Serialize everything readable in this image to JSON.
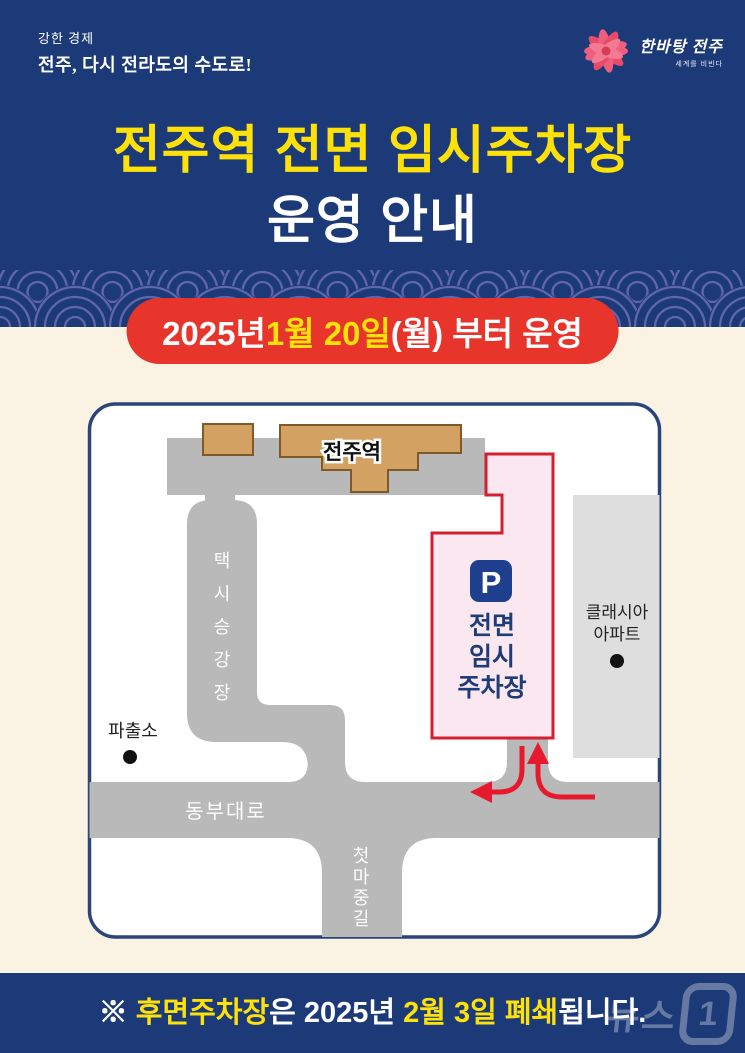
{
  "colors": {
    "header_blue": "#1d3a78",
    "wave_arc": "#6066aa",
    "cream": "#faf3e4",
    "banner_red": "#e8352c",
    "highlight_yellow": "#ffe10a",
    "road_gray": "#b9b9b9",
    "apartment_gray": "#dedede",
    "building_tan": "#d3a262",
    "building_border": "#7d5a28",
    "parking_pink": "#fbe7f0",
    "parking_border_red": "#d31f2f",
    "p_icon_blue": "#1e3f8e",
    "navy_text": "#1d3c78",
    "arrow_red": "#e6192e",
    "card_border": "#2b4579"
  },
  "header": {
    "slogan_small": "강한 경제",
    "slogan_large": "전주, 다시 전라도의 수도로!",
    "logo_name": "한바탕 전주",
    "logo_sub": "세계를 비빈다",
    "title_line1": "전주역 전면 임시주차장",
    "title_line2": "운영 안내"
  },
  "banner": {
    "part_white1": "2025년 ",
    "part_yellow": "1월 20일",
    "part_white2": "(월) 부터 운영"
  },
  "map": {
    "station_label": "전주역",
    "taxi_chars": [
      "택",
      "시",
      "승",
      "강",
      "장"
    ],
    "parking_icon": "P",
    "parking_lines": [
      "전면",
      "임시",
      "주차장"
    ],
    "apartment_line1": "클래시아",
    "apartment_line2": "아파트",
    "police_label": "파출소",
    "road_main_label": "동부대로",
    "road_side_chars": [
      "첫",
      "마",
      "중",
      "길"
    ]
  },
  "footer": {
    "mark": "※ ",
    "highlight1": "후면주차장",
    "middle": "은 2025년 ",
    "highlight2": "2월 3일 폐쇄",
    "suffix": "됩니다.",
    "watermark_text": "뉴스",
    "watermark_number": "1"
  }
}
